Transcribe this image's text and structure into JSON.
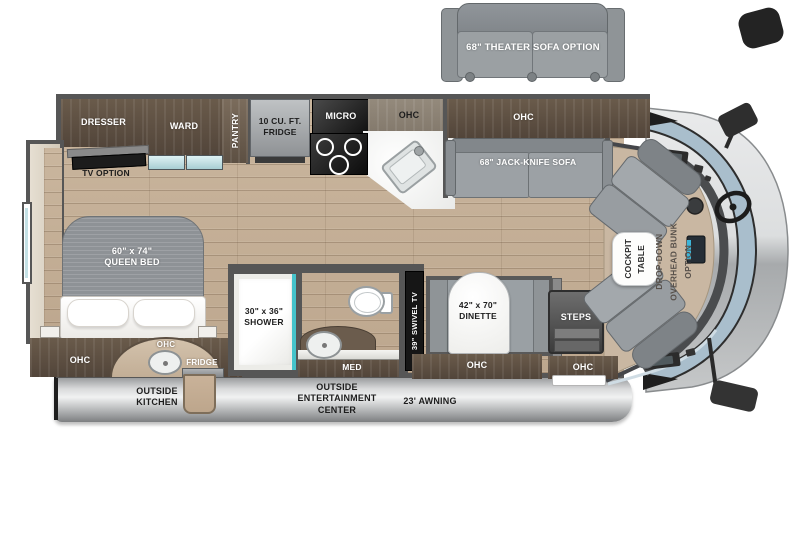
{
  "options": {
    "theater_sofa": "68\" THEATER SOFA OPTION"
  },
  "bedroom": {
    "dresser": "DRESSER",
    "ward": "WARD",
    "tv_option": "TV OPTION",
    "bed": "60\" x 74\"\nQUEEN BED",
    "ohc": "OHC"
  },
  "kitchen": {
    "pantry": "PANTRY",
    "fridge": "10 CU. FT.\nFRIDGE",
    "micro": "MICRO",
    "ohc": "OHC"
  },
  "living": {
    "ohc": "OHC",
    "sofa": "68\" JACK-KNIFE SOFA",
    "tv": "39\" SWIVEL TV",
    "dinette": "42\" x 70\"\nDINETTE",
    "dinette_ohc": "OHC"
  },
  "bath": {
    "shower": "30\" x 36\"\nSHOWER",
    "med": "MED"
  },
  "entry": {
    "steps": "STEPS",
    "ohc": "OHC"
  },
  "cockpit": {
    "table": "COCKPIT\nTABLE",
    "bunk": "DROP-DOWN\nOVERHEAD BUNK\nOPTION"
  },
  "exterior": {
    "outside_kitchen": "OUTSIDE\nKITCHEN",
    "entertainment": "OUTSIDE\nENTERTAINMENT\nCENTER",
    "awning": "23' AWNING",
    "ohc": "OHC",
    "fridge": "FRIDGE"
  },
  "colors": {
    "wood_floor": "#c6b29a",
    "cabinet_brown": "#5e5143",
    "wall_gray": "#565656",
    "sofa_gray": "#9aa0a4",
    "counter_white": "#f4f4f2",
    "shower_teal": "#45c3cb",
    "glass_blue": "#bcdfe3",
    "windshield_blue": "#a9becc",
    "hood_silver": "#d7d9da",
    "awning_silver": "#d9dadb",
    "cockpit_tan": "#c9b7a2",
    "mattress_gray": "#8e9296"
  }
}
